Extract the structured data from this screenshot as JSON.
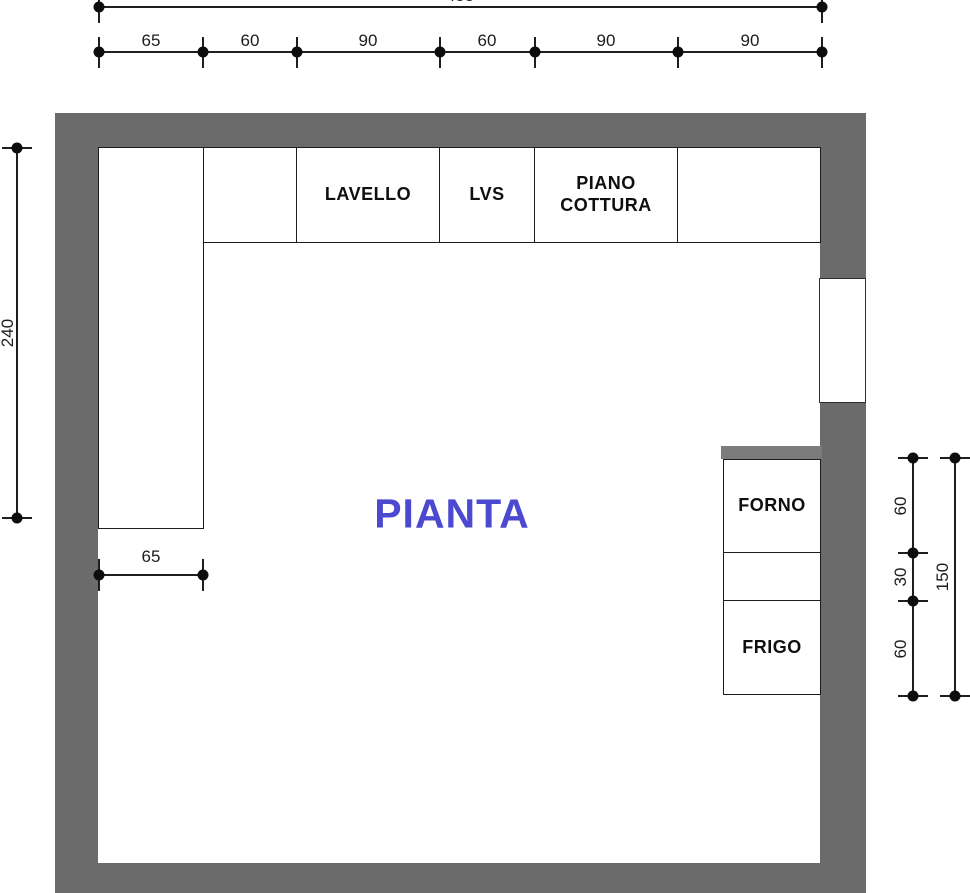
{
  "plan_title": "PIANTA",
  "fixtures": {
    "sink": "LAVELLO",
    "dishwasher": "LVS",
    "cooktop": "PIANO COTTURA",
    "oven": "FORNO",
    "fridge": "FRIGO"
  },
  "dimensions": {
    "top_total": "455",
    "top_segments": [
      "65",
      "60",
      "90",
      "60",
      "90",
      "90"
    ],
    "left_wall": "240",
    "left_column_width": "65",
    "right_segments": [
      "60",
      "30",
      "60"
    ],
    "right_total": "150"
  },
  "colors": {
    "wall": "#6b6b6b",
    "counter_edge_bar": "#7c7c7c",
    "title_text": "#4a49d0",
    "line": "#1f1f1f"
  }
}
